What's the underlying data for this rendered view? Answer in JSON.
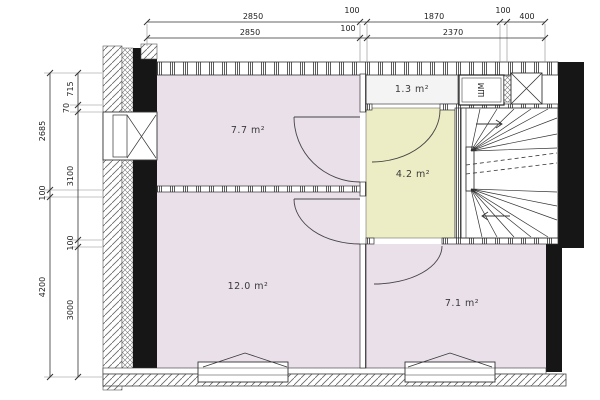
{
  "title": "Apartment floor plan",
  "colors": {
    "room_pink": "#EAE0EA",
    "room_yellow": "#ECEDC5",
    "room_light": "#F4F4F4",
    "wall_black": "#161616",
    "line_dark": "#3a3a3a",
    "canvas_bg": "#FFFFFF"
  },
  "rooms": [
    {
      "id": "room-7-7",
      "area_label": "7.7 m²"
    },
    {
      "id": "room-1-3",
      "area_label": "1.3 m²"
    },
    {
      "id": "room-4-2",
      "area_label": "4.2 m²"
    },
    {
      "id": "room-12-0",
      "area_label": "12.0 m²"
    },
    {
      "id": "room-7-1",
      "area_label": "7.1 m²"
    }
  ],
  "fixtures": {
    "washing_machine_label": "ШМ"
  },
  "dimensions": {
    "top_row1": [
      "2850",
      "100",
      "1870",
      "100",
      "400"
    ],
    "top_row2": [
      "2850",
      "100",
      "2370"
    ],
    "left_outer": [
      "2685",
      "100",
      "4200"
    ],
    "left_inner": [
      "715",
      "70",
      "3100",
      "100",
      "3000"
    ]
  }
}
